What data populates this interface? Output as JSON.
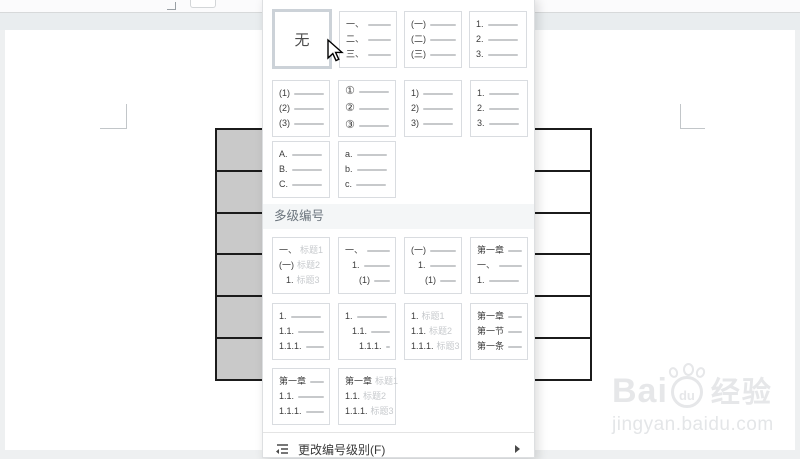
{
  "dropdown": {
    "none_tile": {
      "label": "无",
      "selected": true
    },
    "simple_rows": [
      [
        {
          "type": "none"
        },
        {
          "entries": [
            {
              "n": "一、",
              "line": true
            },
            {
              "n": "二、",
              "line": true
            },
            {
              "n": "三、",
              "line": true
            }
          ]
        },
        {
          "entries": [
            {
              "n": "(一)",
              "line": true
            },
            {
              "n": "(二)",
              "line": true
            },
            {
              "n": "(三)",
              "line": true
            }
          ]
        },
        {
          "entries": [
            {
              "n": "1.",
              "line": true
            },
            {
              "n": "2.",
              "line": true
            },
            {
              "n": "3.",
              "line": true
            }
          ]
        }
      ],
      [
        {
          "entries": [
            {
              "n": "(1)",
              "line": true
            },
            {
              "n": "(2)",
              "line": true
            },
            {
              "n": "(3)",
              "line": true
            }
          ]
        },
        {
          "entries": [
            {
              "n": "①",
              "line": true,
              "circ": true
            },
            {
              "n": "②",
              "line": true,
              "circ": true
            },
            {
              "n": "③",
              "line": true,
              "circ": true
            }
          ]
        },
        {
          "entries": [
            {
              "n": "1)",
              "line": true
            },
            {
              "n": "2)",
              "line": true
            },
            {
              "n": "3)",
              "line": true
            }
          ]
        },
        {
          "entries": [
            {
              "n": "1.",
              "line": true
            },
            {
              "n": "2.",
              "line": true
            },
            {
              "n": "3.",
              "line": true
            }
          ]
        }
      ],
      [
        {
          "entries": [
            {
              "n": "A.",
              "line": true
            },
            {
              "n": "B.",
              "line": true
            },
            {
              "n": "C.",
              "line": true
            }
          ]
        },
        {
          "entries": [
            {
              "n": "a.",
              "line": true
            },
            {
              "n": "b.",
              "line": true
            },
            {
              "n": "c.",
              "line": true
            }
          ]
        }
      ]
    ],
    "multilevel_header": "多级编号",
    "multilevel_rows": [
      [
        {
          "entries": [
            {
              "n": "一、",
              "g": "标题1"
            },
            {
              "n": "(一)",
              "g": "标题2"
            },
            {
              "n": "1.",
              "g": "标题3",
              "ind": 1
            }
          ]
        },
        {
          "entries": [
            {
              "n": "一、",
              "line": true
            },
            {
              "n": "1.",
              "line": true,
              "ind": 1
            },
            {
              "n": "(1)",
              "line": true,
              "ind": 2
            }
          ]
        },
        {
          "entries": [
            {
              "n": "(一)",
              "line": true
            },
            {
              "n": "1.",
              "line": true,
              "ind": 1
            },
            {
              "n": "(1)",
              "line": true,
              "ind": 2
            }
          ]
        },
        {
          "entries": [
            {
              "n": "第一章",
              "line": true
            },
            {
              "n": "一、",
              "line": true
            },
            {
              "n": "1.",
              "line": true
            }
          ]
        }
      ],
      [
        {
          "entries": [
            {
              "n": "1.",
              "line": true
            },
            {
              "n": "1.1.",
              "line": true
            },
            {
              "n": "1.1.1.",
              "line": true
            }
          ]
        },
        {
          "entries": [
            {
              "n": "1.",
              "line": true
            },
            {
              "n": "1.1.",
              "line": true,
              "ind": 1
            },
            {
              "n": "1.1.1.",
              "line": true,
              "ind": 2
            }
          ]
        },
        {
          "entries": [
            {
              "n": "1.",
              "g": "标题1"
            },
            {
              "n": "1.1.",
              "g": "标题2"
            },
            {
              "n": "1.1.1.",
              "g": "标题3"
            }
          ]
        },
        {
          "entries": [
            {
              "n": "第一章",
              "line": true
            },
            {
              "n": "第一节",
              "line": true
            },
            {
              "n": "第一条",
              "line": true
            }
          ]
        }
      ],
      [
        {
          "entries": [
            {
              "n": "第一章",
              "line": true
            },
            {
              "n": "1.1.",
              "line": true
            },
            {
              "n": "1.1.1.",
              "line": true
            }
          ]
        },
        {
          "entries": [
            {
              "n": "第一章",
              "g": "标题1"
            },
            {
              "n": "1.1.",
              "g": "标题2"
            },
            {
              "n": "1.1.1.",
              "g": "标题3"
            }
          ]
        }
      ]
    ],
    "footer": {
      "label": "更改编号级别(F)"
    }
  },
  "document": {
    "table": {
      "rows": 6,
      "gray_first_column": true
    }
  },
  "watermark": {
    "bai": "Bai",
    "du": "du",
    "suffix": "经验",
    "url": "jingyan.baidu.com"
  },
  "colors": {
    "selected_tile_border": "#ccd2d8",
    "table_border": "#1b1b1b",
    "gray_cell": "#c9c9c9",
    "section_header_bg": "#f4f6f7"
  }
}
